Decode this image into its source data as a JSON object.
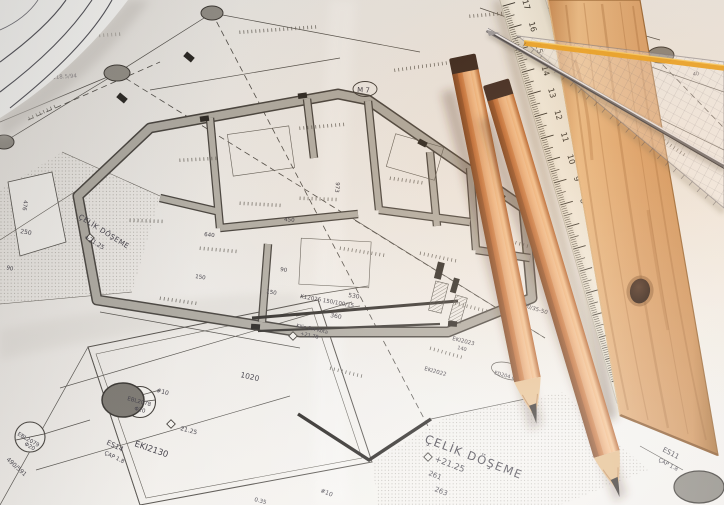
{
  "blueprint": {
    "labels": {
      "celik_doseme_main": "ÇELİK DÖŞEME",
      "level_main": "+21.25",
      "dim_261": "261",
      "dim_263": "263",
      "celik_doseme_left": "ÇELİK DÖŞEME",
      "level_left": "+21.25",
      "eki2130": "EKI2130",
      "es14": "ES14",
      "cap18_a": "ÇAP 1.8",
      "es11": "ES11",
      "cap18_b": "ÇAP 1.8",
      "ebl2078": "EBL2078",
      "phi20_a": "Φ20",
      "ebl2079": "EBL2079",
      "phi20_b": "Φ20",
      "level_2125": "21.25",
      "dim_1020": "1020",
      "k12026": "K12026 150/100/15",
      "dim_360": "360",
      "dim_530": "530",
      "kilis": "Kilis Ort Kota",
      "level_2178": "+21.78",
      "dim_150a": "150",
      "dim_250": "250",
      "dim_476": "476",
      "dim_90a": "90",
      "m7": "M 7",
      "dim_800": "800-118.5/94",
      "n10_a": "#10",
      "n10_b": "#10",
      "dim_640": "640",
      "dim_450": "450",
      "dim_150b": "150",
      "dim_90b": "90",
      "dim_973": "973",
      "eki2023": "EKI2023",
      "eki2022": "EKI2022",
      "dim_140": "140",
      "dim_5035": "150/35-50",
      "ed204": "ED204 Φ10",
      "dim_490": "490/591",
      "dim_035": "0.35",
      "dim_40a": "40",
      "dim_40b": "40"
    }
  },
  "tools": {
    "white_ruler": {
      "numbers": [
        "0",
        "1",
        "2",
        "3",
        "4",
        "5",
        "6",
        "7",
        "8",
        "9",
        "10",
        "11",
        "12",
        "13",
        "14",
        "15",
        "16",
        "17"
      ],
      "end_label": "17.0"
    }
  },
  "colors": {
    "paper": "#edeae6",
    "ink": "#35323c",
    "wall_gray": "#a9a59c",
    "column_gray": "#8f8b83",
    "pencil_wood": "#d4854e",
    "ruler_wood": "#dba06a",
    "ruler_cream": "#eeebdf",
    "triangle_stripe": "#f0a41d"
  }
}
